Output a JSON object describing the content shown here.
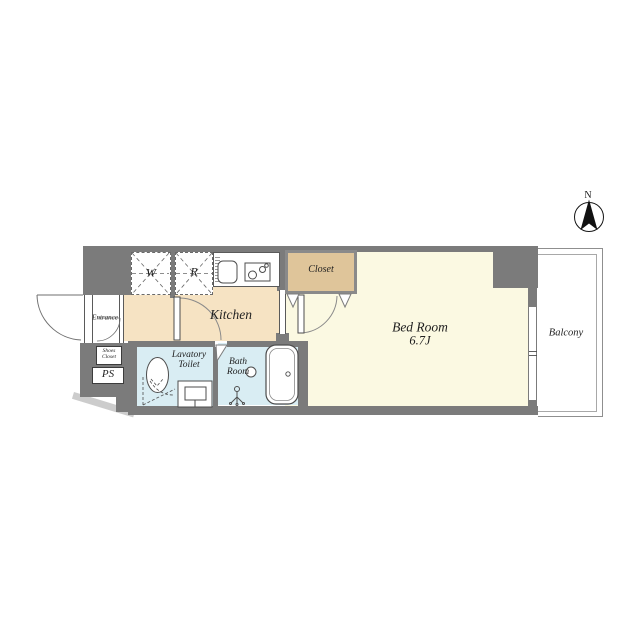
{
  "compass": {
    "north": "N"
  },
  "rooms": {
    "kitchen": {
      "label": "Kitchen"
    },
    "bedroom": {
      "label": "Bed Room",
      "size": "6.7J"
    },
    "closet": {
      "label": "Closet"
    },
    "balcony": {
      "label": "Balcony"
    },
    "lavatory": {
      "line1": "Lavatory",
      "line2": "Toilet"
    },
    "bathroom": {
      "line1": "Bath",
      "line2": "Room"
    },
    "entrance": {
      "label": "Entrance"
    },
    "shoes_closet": {
      "line1": "Shoes",
      "line2": "Closet"
    },
    "pipe_space": {
      "label": "PS"
    }
  },
  "fixtures": {
    "washer": {
      "label": "W"
    },
    "refrigerator": {
      "label": "R"
    }
  },
  "colors": {
    "wall": "#7b7b7b",
    "kitchen_floor": "#f6e3c3",
    "bedroom_floor": "#fbf9e2",
    "closet_fill": "#dfc59a",
    "wet_area_floor": "#d9edf3",
    "fixture_line": "#4d4d4d"
  }
}
